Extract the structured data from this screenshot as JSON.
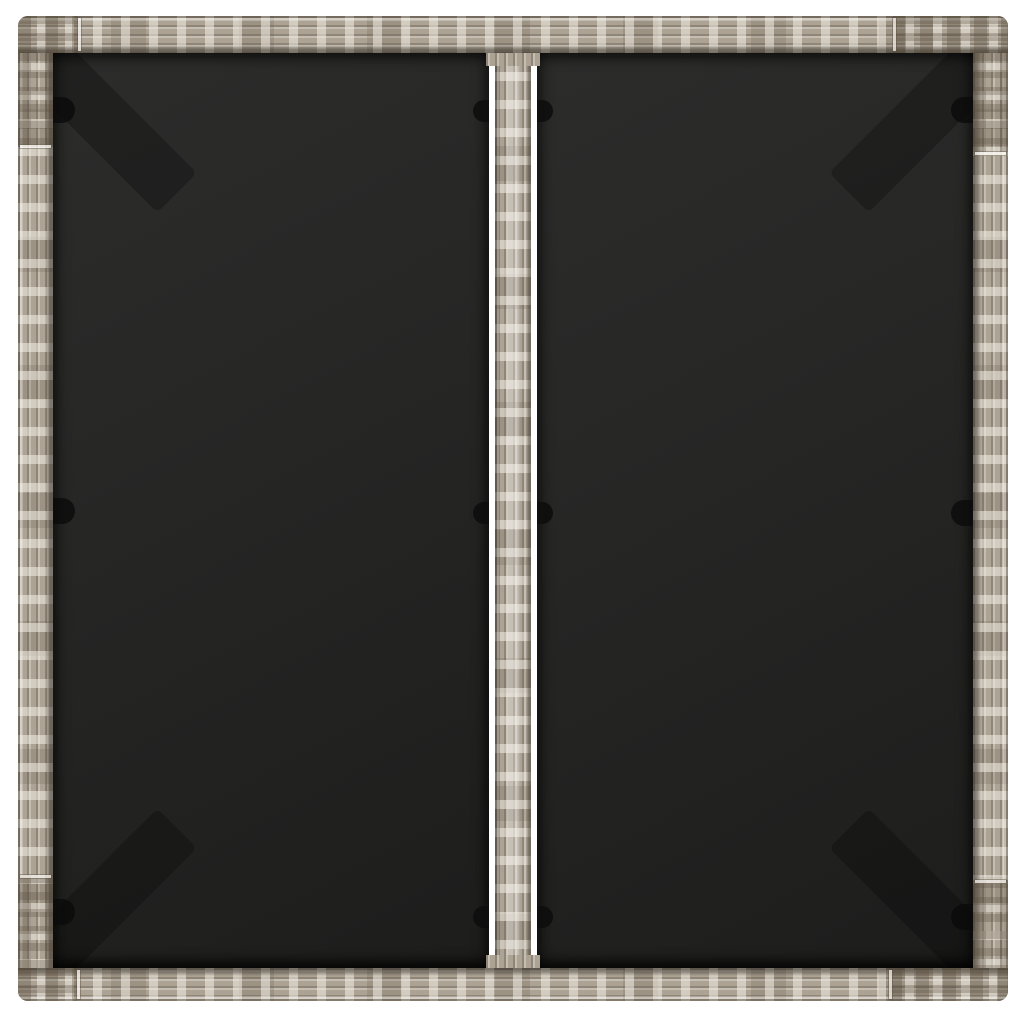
{
  "meta": {
    "type": "product-photo",
    "subject": "Top view of a square garden table with a grey poly rattan woven frame, a central rattan divider strip and two dark tempered-glass tabletop panels on a white background"
  },
  "colors": {
    "page-background": "#ffffff",
    "rattan-base": "#b4ab9d",
    "rattan-light": "#d8d1c3",
    "rattan-mid": "#c3bbad",
    "rattan-dark": "#8a8173",
    "rattan-deep": "#6e6658",
    "glass-top": "#2c2c2b",
    "glass-bottom": "#1d1d1c",
    "clip": "#0e0e0e",
    "gap-white": "#ffffff"
  },
  "parts": {
    "frame": "grey poly rattan frame (woven segments with corner pieces)",
    "glass_left": "black glass panel, left half",
    "glass_right": "black glass panel, right half",
    "center_strip": "central woven rattan divider strip",
    "clips": "black glass retaining clips on rails and centre strip",
    "corner_brackets": "dark corner support brackets visible through the glass"
  }
}
